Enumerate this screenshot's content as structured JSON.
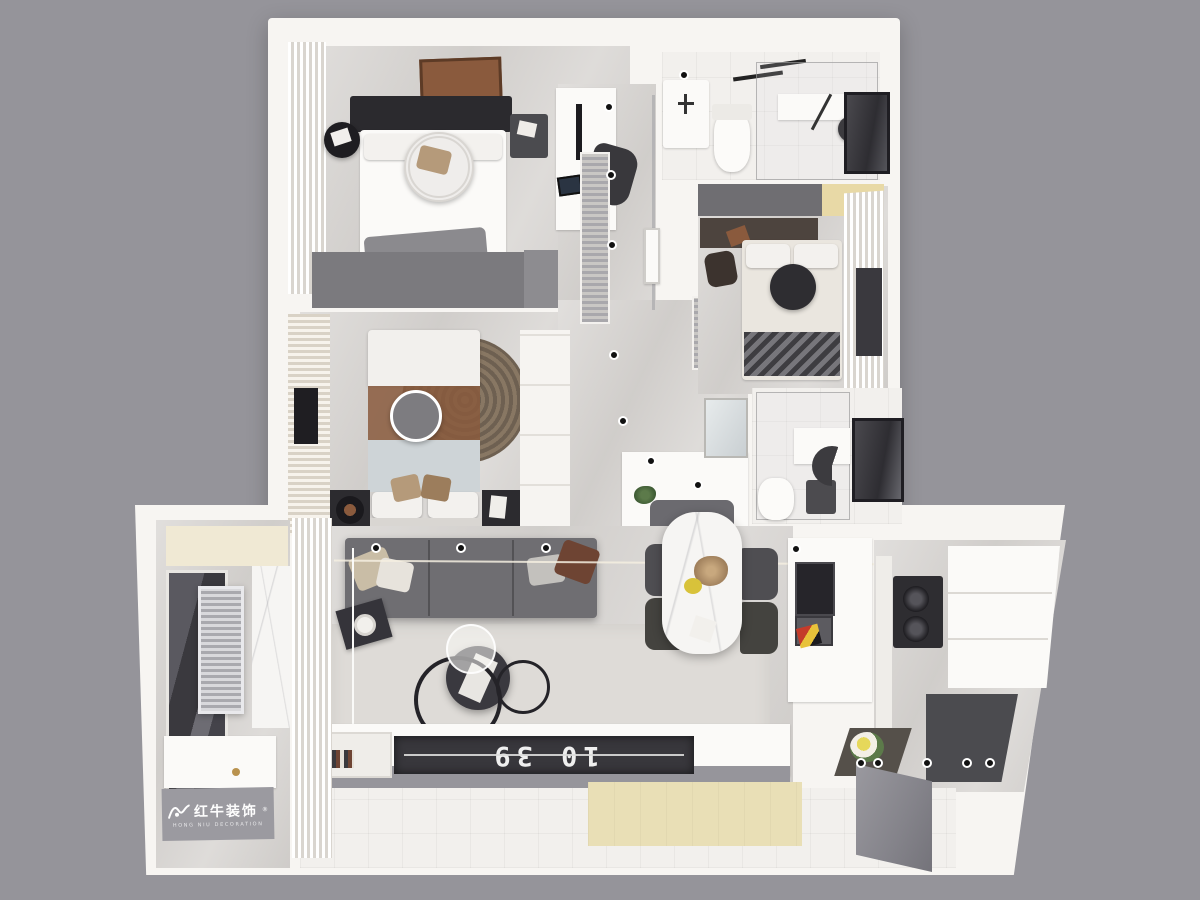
{
  "palette": {
    "bg": "#95949a",
    "wall": "#f7f5f2",
    "floor": "#d7d4d1",
    "gray-furn": "#6f6e72",
    "gray-dark": "#4b4b4f",
    "near-black": "#2b2a2e",
    "beige": "#e9dfb6",
    "brown": "#8a5a3d",
    "herr": "#3e3d41",
    "window-dark": "#3a393e",
    "door-gray": "#8e8d93",
    "plate": "#9b9aa0"
  },
  "logo": {
    "brand": "红牛装饰",
    "subtitle": "HONG NIU DECORATION",
    "registered": "®",
    "icon": "bull-icon"
  },
  "living_room": {
    "tv_clock": "10 39"
  }
}
